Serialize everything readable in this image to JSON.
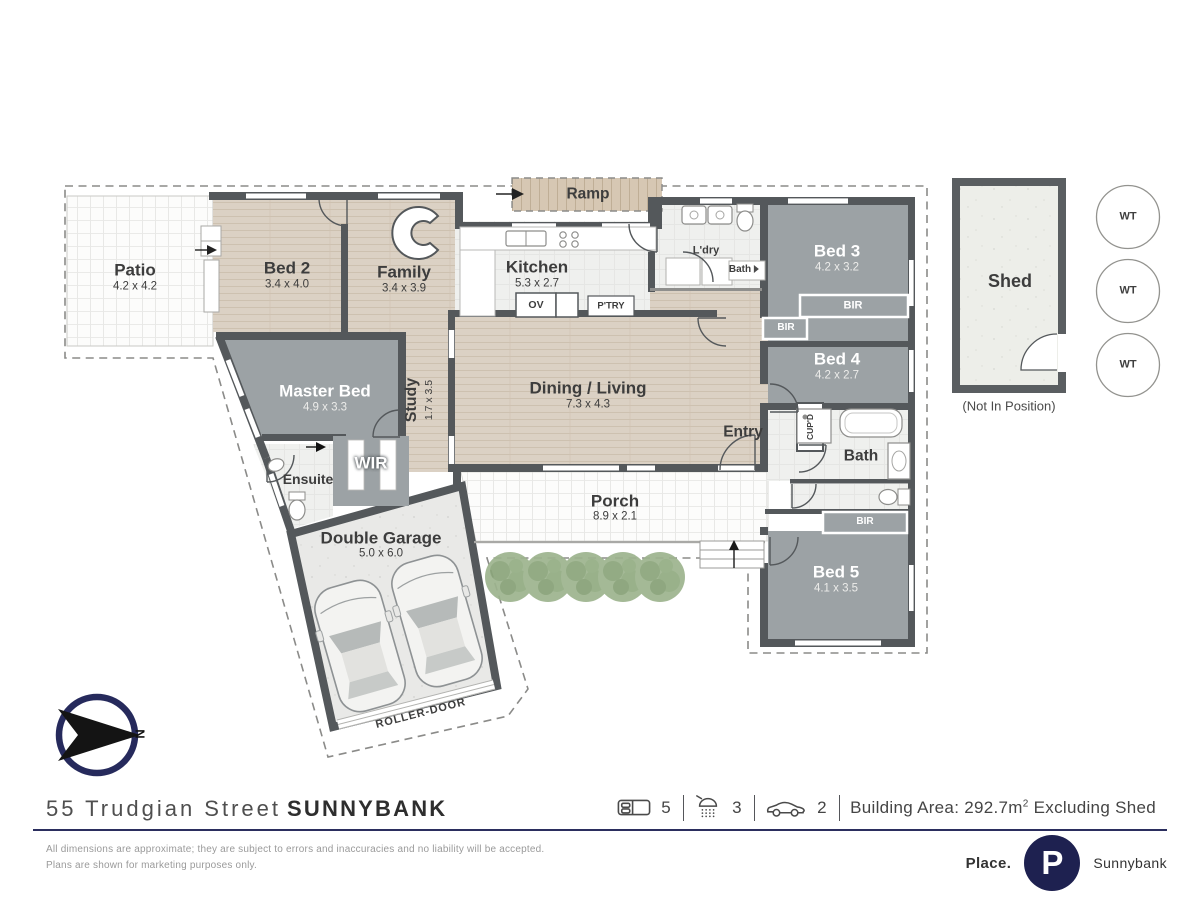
{
  "plan": {
    "rooms": {
      "patio": {
        "name": "Patio",
        "dims": "4.2 x 4.2"
      },
      "bed2": {
        "name": "Bed 2",
        "dims": "3.4 x 4.0"
      },
      "family": {
        "name": "Family",
        "dims": "3.4 x 3.9"
      },
      "kitchen": {
        "name": "Kitchen",
        "dims": "5.3 x 2.7"
      },
      "ramp": {
        "name": "Ramp"
      },
      "laundry": {
        "name": "L'dry"
      },
      "bath_top": {
        "name": "Bath"
      },
      "bed3": {
        "name": "Bed 3",
        "dims": "4.2 x 3.2",
        "bir": "BIR"
      },
      "bed4": {
        "name": "Bed 4",
        "dims": "4.2 x 2.7",
        "bir": "BIR"
      },
      "master": {
        "name": "Master Bed",
        "dims": "4.9 x 3.3"
      },
      "study": {
        "name": "Study",
        "dims": "1.7 x 3.5"
      },
      "dining": {
        "name": "Dining / Living",
        "dims": "7.3 x 4.3"
      },
      "entry": {
        "name": "Entry"
      },
      "cupboard": {
        "name": "CUP'D"
      },
      "bath_main": {
        "name": "Bath"
      },
      "wir": {
        "name": "WIR"
      },
      "ensuite": {
        "name": "Ensuite"
      },
      "garage": {
        "name": "Double Garage",
        "dims": "5.0 x 6.0"
      },
      "porch": {
        "name": "Porch",
        "dims": "8.9 x 2.1"
      },
      "bed5": {
        "name": "Bed 5",
        "dims": "4.1 x 3.5",
        "bir": "BIR"
      },
      "oven": {
        "name": "OV"
      },
      "pantry": {
        "name": "P'TRY"
      },
      "roller_door": {
        "name": "ROLLER-DOOR"
      }
    },
    "shed": {
      "name": "Shed",
      "note": "(Not In Position)"
    },
    "water_tank_label": "WT",
    "compass_north": "N"
  },
  "footer": {
    "address_street": "55 Trudgian Street",
    "address_suburb": "SUNNYBANK",
    "stats": {
      "beds": "5",
      "baths": "3",
      "cars": "2"
    },
    "area_label": "Building Area: 292.7m",
    "area_sup": "2",
    "area_suffix": "Excluding Shed",
    "disclaimer_line1": "All dimensions are approximate; they are subject to errors and inaccuracies and no liability will be accepted.",
    "disclaimer_line2": "Plans are shown for marketing purposes only.",
    "brand": {
      "name": "Place.",
      "initial": "P",
      "office": "Sunnybank"
    }
  },
  "colors": {
    "navy": "#23265A",
    "wall": "#54585B",
    "bedroom_gray": "#9CA2A5",
    "wood": "#DBD1C4",
    "tile": "#EFF0EE",
    "bush_green": "#9DB48E"
  }
}
